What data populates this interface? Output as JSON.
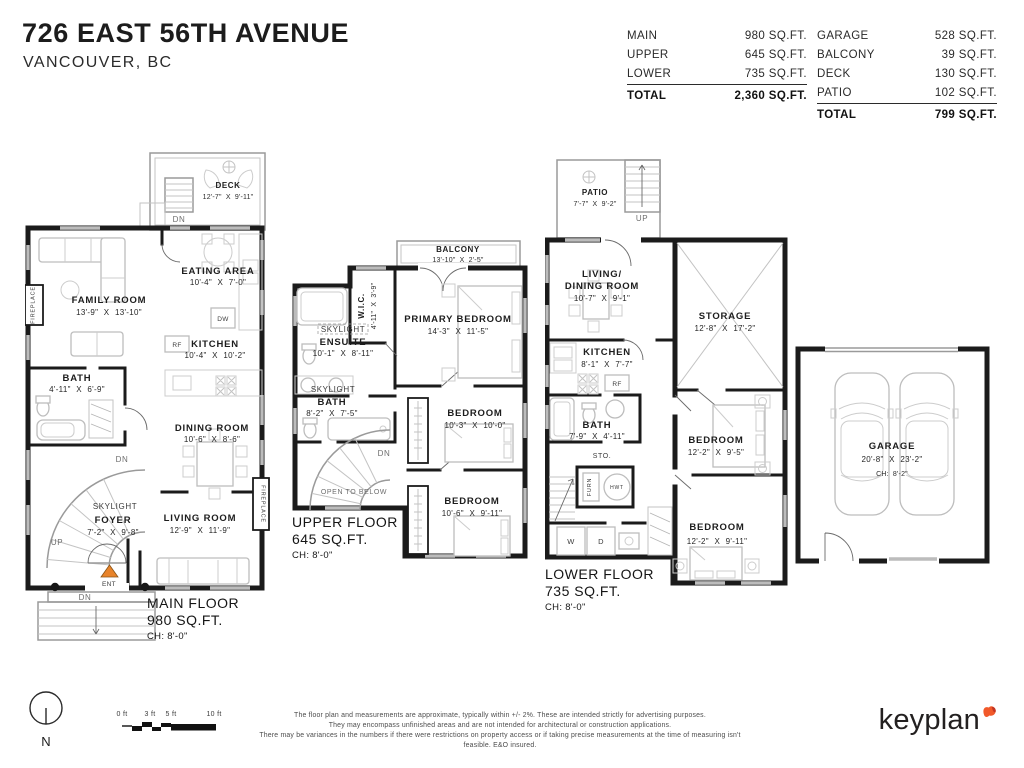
{
  "header": {
    "title": "726 EAST 56TH AVENUE",
    "subtitle": "VANCOUVER, BC"
  },
  "interior_table": {
    "rows": [
      {
        "label": "MAIN",
        "value": "980 SQ.FT."
      },
      {
        "label": "UPPER",
        "value": "645 SQ.FT."
      },
      {
        "label": "LOWER",
        "value": "735 SQ.FT."
      }
    ],
    "total": {
      "label": "TOTAL",
      "value": "2,360 SQ.FT."
    }
  },
  "exterior_table": {
    "rows": [
      {
        "label": "GARAGE",
        "value": "528 SQ.FT."
      },
      {
        "label": "BALCONY",
        "value": "39 SQ.FT."
      },
      {
        "label": "DECK",
        "value": "130 SQ.FT."
      },
      {
        "label": "PATIO",
        "value": "102 SQ.FT."
      }
    ],
    "total": {
      "label": "TOTAL",
      "value": "799 SQ.FT."
    }
  },
  "floors": {
    "main": {
      "floor_label": {
        "name": "MAIN FLOOR",
        "area": "980 SQ.FT.",
        "ceiling": "CH: 8'-0\""
      },
      "rooms": {
        "deck": {
          "name": "DECK",
          "dims": "12'-7\" X 9'-11\""
        },
        "family_room": {
          "name": "FAMILY ROOM",
          "dims": "13'-9\" X 13'-10\""
        },
        "eating_area": {
          "name": "EATING AREA",
          "dims": "10'-4\" X 7'-0\""
        },
        "kitchen": {
          "name": "KITCHEN",
          "dims": "10'-4\" X 10'-2\""
        },
        "bath": {
          "name": "BATH",
          "dims": "4'-11\" X 6'-9\""
        },
        "dining_room": {
          "name": "DINING ROOM",
          "dims": "10'-6\" X 8'-6\""
        },
        "foyer": {
          "name": "FOYER",
          "dims": "7'-2\" X 9'-8\""
        },
        "living_room": {
          "name": "LIVING ROOM",
          "dims": "12'-9\" X 11'-9\""
        }
      },
      "annotations": {
        "skylight": "SKYLIGHT",
        "fireplace": "FIREPLACE",
        "ent": "ENT",
        "deck_dn": "DN",
        "stair_dn": "DN",
        "stair_up": "UP",
        "porch_dn": "DN",
        "rf": "RF",
        "dw": "DW"
      }
    },
    "upper": {
      "floor_label": {
        "name": "UPPER FLOOR",
        "area": "645 SQ.FT.",
        "ceiling": "CH: 8'-0\""
      },
      "rooms": {
        "balcony": {
          "name": "BALCONY",
          "dims": "13'-10\" X 2'-5\""
        },
        "wic": {
          "name": "W.I.C.",
          "dims": "4'-11\" X 3'-9\""
        },
        "primary_bedroom": {
          "name": "PRIMARY BEDROOM",
          "dims": "14'-3\" X 11'-5\""
        },
        "ensuite": {
          "name": "ENSUITE",
          "dims": "10'-1\" X 8'-11\""
        },
        "bath": {
          "name": "BATH",
          "dims": "8'-2\" X 7'-5\""
        },
        "bedroom1": {
          "name": "BEDROOM",
          "dims": "10'-3\" X 10'-0\""
        },
        "bedroom2": {
          "name": "BEDROOM",
          "dims": "10'-6\" X 9'-11\""
        }
      },
      "annotations": {
        "skylight": "SKYLIGHT",
        "dn": "DN",
        "open_to_below": "OPEN TO BELOW"
      }
    },
    "lower": {
      "floor_label": {
        "name": "LOWER FLOOR",
        "area": "735 SQ.FT.",
        "ceiling": "CH: 8'-0\""
      },
      "rooms": {
        "patio": {
          "name": "PATIO",
          "dims": "7'-7\" X 9'-2\""
        },
        "living_dining": {
          "name_line1": "LIVING/",
          "name_line2": "DINING ROOM",
          "dims": "10'-7\" X 9'-1\""
        },
        "storage": {
          "name": "STORAGE",
          "dims": "12'-8\" X 17'-2\""
        },
        "kitchen": {
          "name": "KITCHEN",
          "dims": "8'-1\" X 7'-7\""
        },
        "bath": {
          "name": "BATH",
          "dims": "7'-9\" X 4'-11\""
        },
        "bedroom1": {
          "name": "BEDROOM",
          "dims": "12'-2\" X 9'-5\""
        },
        "bedroom2": {
          "name": "BEDROOM",
          "dims": "12'-2\" X 9'-11\""
        }
      },
      "annotations": {
        "patio_up": "UP",
        "stair_up": "UP",
        "sto": "STO.",
        "furn": "FURN",
        "hwt": "HWT",
        "washer": "W",
        "dryer": "D",
        "rf": "RF"
      }
    },
    "garage": {
      "name": "GARAGE",
      "dims": "20'-8\" X 23'-2\"",
      "ceiling": "CH: 8'-2\""
    }
  },
  "footer": {
    "north_label": "N",
    "scale_ticks": [
      "0 ft",
      "3 ft",
      "5 ft",
      "10 ft"
    ],
    "disclaimer": [
      "The floor plan and measurements are approximate, typically within +/- 2%. These are intended strictly for advertising purposes.",
      "They may encompass unfinished areas and are not intended for architectural or construction applications.",
      "There may be variances in the numbers if there were restrictions on property access or if taking precise measurements at the time of measuring isn't feasible. E&O insured."
    ],
    "brand": "keyplan"
  },
  "colors": {
    "wall": "#1b1b1b",
    "entry_marker": "#E8832A",
    "brand_mark": "#F1592A"
  }
}
